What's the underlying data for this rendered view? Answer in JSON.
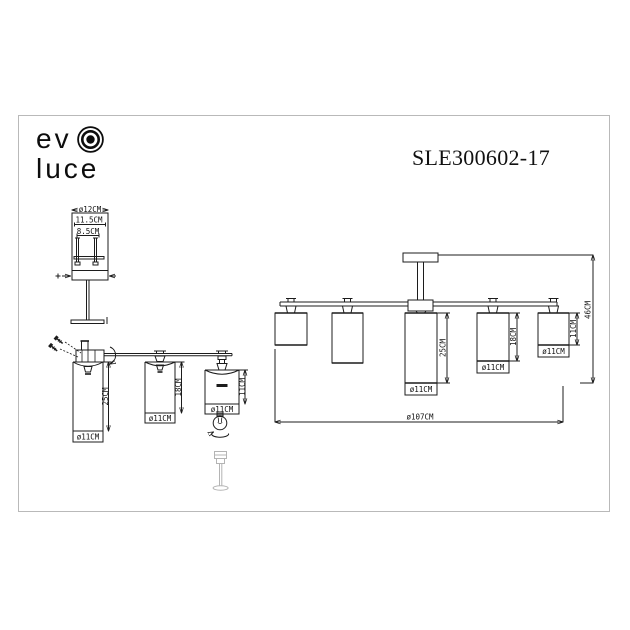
{
  "colors": {
    "line": "#1c1c1c",
    "border": "#b9b9b9",
    "background": "#ffffff",
    "light_part": "#b4b4b4"
  },
  "brand": {
    "word_top": "ev",
    "word_bottom": "luce"
  },
  "model_number": "SLE300602-17",
  "shade_detail_view": {
    "top_diameter_label": "ø12CM",
    "outer_width_label": "11.5CM",
    "inner_width_label": "8.5CM"
  },
  "side_perspective_view": {
    "large_shade": {
      "height_label": "25CM",
      "diameter_label": "ø11CM"
    },
    "medium_shade": {
      "height_label": "18CM",
      "diameter_label": "ø11CM"
    },
    "small_shade": {
      "height_label": "11CM",
      "diameter_label": "ø11CM"
    }
  },
  "front_view": {
    "center_shade": {
      "height_label": "25CM",
      "diameter_label": "ø11CM"
    },
    "mid_shade": {
      "height_label": "18CM",
      "diameter_label": "ø11CM"
    },
    "end_shade": {
      "height_label": "11CM",
      "diameter_label": "ø11CM"
    },
    "overall_width_label": "ø107CM",
    "overall_height_label": "46CM"
  }
}
